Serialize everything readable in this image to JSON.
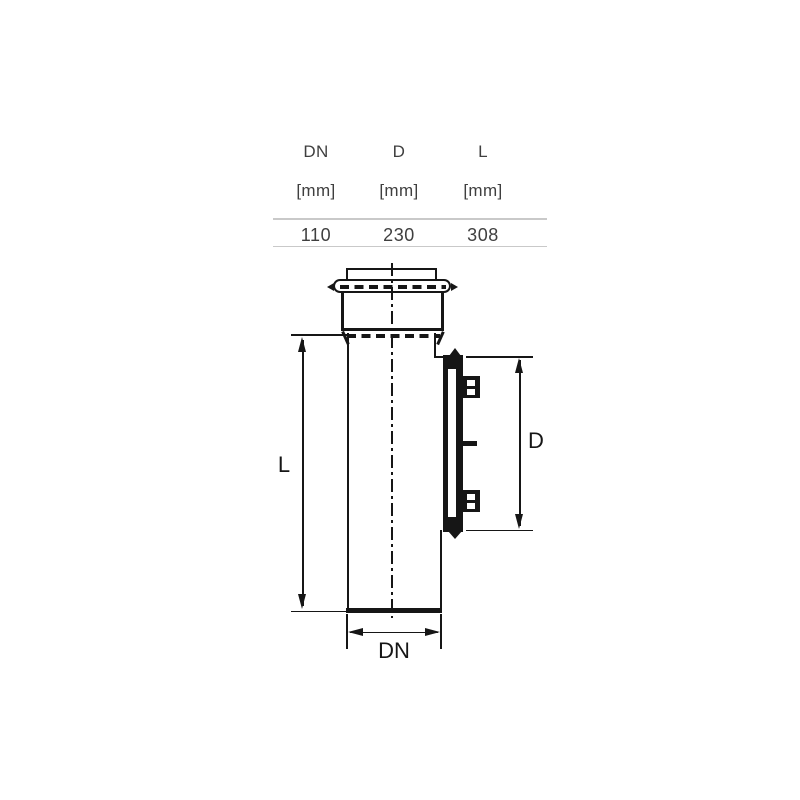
{
  "table": {
    "columns": [
      {
        "name": "DN",
        "unit": "[mm]",
        "value": "110"
      },
      {
        "name": "D",
        "unit": "[mm]",
        "value": "230"
      },
      {
        "name": "L",
        "unit": "[mm]",
        "value": "308"
      }
    ]
  },
  "diagram": {
    "type": "technical-drawing-pipe-access-fitting",
    "labels": {
      "length": "L",
      "diameter": "D",
      "nominal_diameter": "DN"
    }
  },
  "colors": {
    "line": "#161616",
    "table_text": "#3f3f3f",
    "table_rule": "#c9c9c9",
    "background": "#ffffff"
  }
}
